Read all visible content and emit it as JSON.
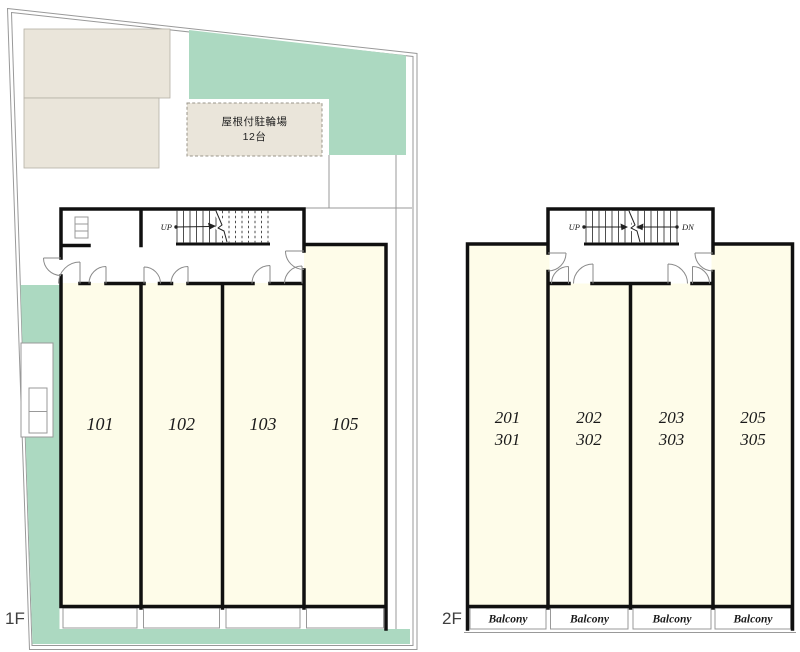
{
  "colors": {
    "cream": "#FEFCE9",
    "green": "#ACD9C1",
    "beige": "#EAE5DA",
    "wall": "#101010",
    "line": "#999999",
    "ink": "#1a1a1a"
  },
  "floor1": {
    "label": "1F",
    "bike_parking_line1": "屋根付駐輪場",
    "bike_parking_line2": "12台",
    "stair_up": "UP",
    "rooms": [
      "101",
      "102",
      "103",
      "105"
    ]
  },
  "floor2": {
    "label": "2F",
    "stair_up": "UP",
    "stair_down": "DN",
    "rooms": [
      [
        "201",
        "301"
      ],
      [
        "202",
        "302"
      ],
      [
        "203",
        "303"
      ],
      [
        "205",
        "305"
      ]
    ],
    "balcony": "Balcony"
  }
}
